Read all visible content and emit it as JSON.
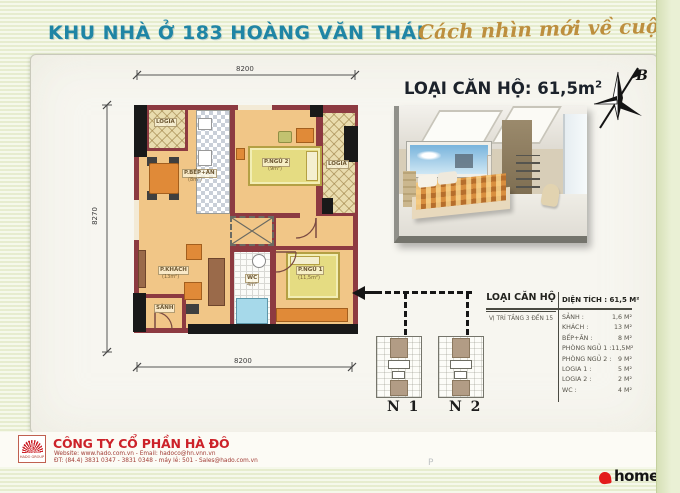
{
  "header": {
    "title": "KHU NHÀ Ở 183 HOÀNG VĂN THÁI",
    "slogan": "Cách nhìn mới về cuộc sống!"
  },
  "unit": {
    "title": "LOẠI CĂN HỘ: 61,5m",
    "title_sup": "2"
  },
  "compass_label": "B",
  "plan": {
    "dim_top": "8200",
    "dim_bottom": "8200",
    "dim_left": "8270",
    "logia_top": "LOGIA",
    "logia_right": "LOGIA",
    "kitchen": "P.BẾP+ĂN",
    "kitchen_area": "(8m²)",
    "bedroom2": "P.NGỦ 2",
    "bedroom2_area": "(9m²)",
    "living": "P.KHÁCH",
    "living_area": "(13m²)",
    "wc": "WC",
    "wc_area": "4m²",
    "bedroom1": "P.NGỦ 1",
    "bedroom1_area": "(11,5m²)",
    "hall": "SẢNH"
  },
  "spec_table": {
    "header_left": "LOẠI CĂN HỘ",
    "header_right": "DIỆN TÍCH : 61,5 M²",
    "sub_left": "VỊ TRÍ TẦNG 3 ĐẾN 15",
    "rows": [
      {
        "label": "SẢNH :",
        "value": "1,6 M²"
      },
      {
        "label": "KHÁCH :",
        "value": "13 M²"
      },
      {
        "label": "BẾP+ĂN :",
        "value": "8 M²"
      },
      {
        "label": "PHÒNG NGỦ 1 :",
        "value": "11,5M²"
      },
      {
        "label": "PHÒNG NGỦ 2 :",
        "value": "9 M²"
      },
      {
        "label": "LOGIA 1 :",
        "value": "5 M²"
      },
      {
        "label": "LOGIA 2 :",
        "value": "2 M²"
      },
      {
        "label": "WC :",
        "value": "4 M²"
      }
    ]
  },
  "buildings": {
    "n1": "N 1",
    "n2": "N 2"
  },
  "footer": {
    "company": "CÔNG TY CỔ PHẦN HÀ ĐÔ",
    "logo_caption": "HADO GROUP",
    "line1": "Website: www.hado.com.vn  -  Email: hadoco@hn.vnn.vn",
    "line2": "ĐT: (84.4) 3831 0347 - 3831 0348  -  máy lẻ: 501  -  Sales@hado.com.vn"
  },
  "branding": {
    "homeup": "homeup",
    "watermark": "P"
  },
  "colors": {
    "header_teal": "#1f85a5",
    "slogan_gold": "#bd8f3e",
    "wall_maroon": "#8d3a41",
    "floor_tan": "#f1c687",
    "accent_red": "#cc2229",
    "homeup_red": "#e31b1b"
  }
}
